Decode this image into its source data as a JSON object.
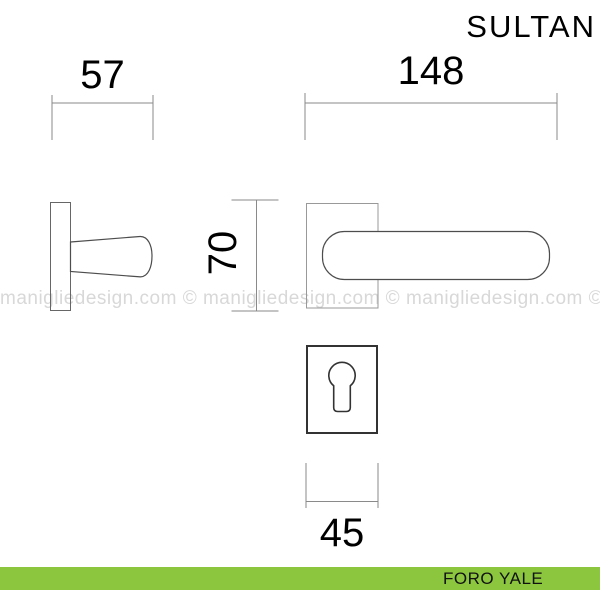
{
  "page": {
    "title": "SULTAN",
    "background_color": "#ffffff"
  },
  "drawing": {
    "dimensions": {
      "side_width": "57",
      "front_width": "148",
      "rosette_height": "70",
      "escutcheon_width": "45"
    },
    "dim_line_color": "#8a8a8a",
    "dim_text_color": "#000000",
    "outline_color": "#4d4d4d",
    "rosette_line_color": "#999999",
    "escutcheon_line_color": "#333333"
  },
  "watermark": {
    "text": "manigliedesign.com © manigliedesign.com © manigliedesign.com ©",
    "color": "#d8d8d8"
  },
  "footer": {
    "label": "FORO YALE",
    "bar_color": "#8cc63f",
    "text_color": "#111111"
  }
}
